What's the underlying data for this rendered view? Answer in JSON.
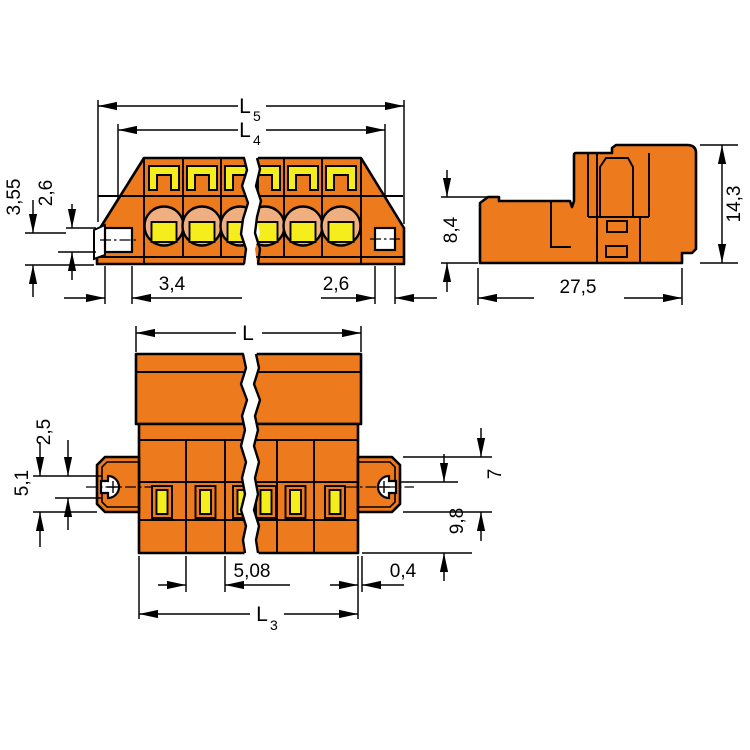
{
  "colors": {
    "body_orange": "#EE7A1E",
    "detail_yellow": "#F6EE1C",
    "screw_face_salmon": "#EFAF80",
    "line_black": "#000000",
    "background_white": "#FFFFFF"
  },
  "dims": {
    "front": {
      "l5": {
        "main": "L",
        "sub": "5"
      },
      "l4": {
        "main": "L",
        "sub": "4"
      },
      "height_355": "3,55",
      "height_26": "2,6",
      "hole_width_34": "3,4",
      "hole_width_26": "2,6"
    },
    "side": {
      "height_84": "8,4",
      "height_143": "14,3",
      "width_275": "27,5"
    },
    "bottom": {
      "l": {
        "main": "L"
      },
      "l3": {
        "main": "L",
        "sub": "3"
      },
      "left_25": "2,5",
      "left_51": "5,1",
      "right_7": "7",
      "right_98": "9,8",
      "pitch_508": "5,08",
      "offset_04": "0,4"
    }
  }
}
